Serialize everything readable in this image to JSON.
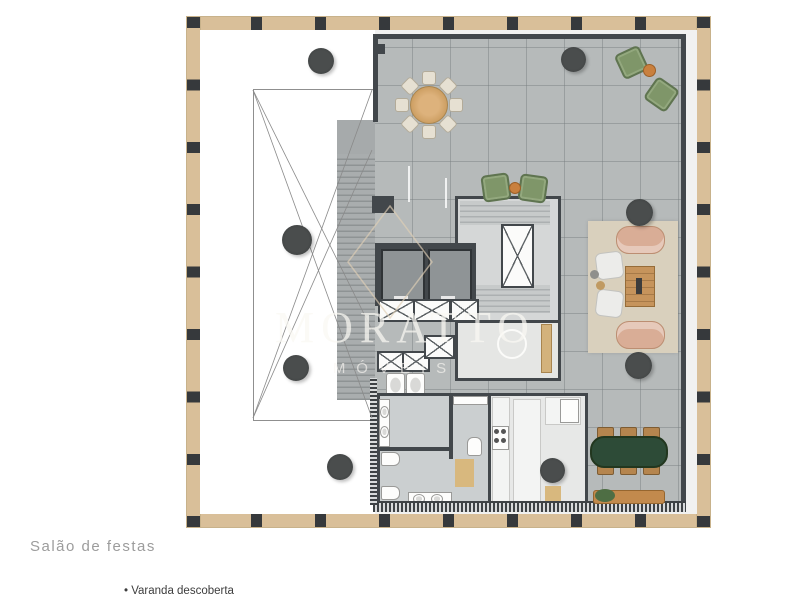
{
  "page": {
    "label_title": "Salão de festas",
    "label_bullet": "• Varanda descoberta"
  },
  "watermark": {
    "brand": "MORATTO",
    "sub": "MÓVEIS"
  },
  "palette": {
    "frame_wood": "#d9bf99",
    "frame_post": "#36393c",
    "deck_tile": "#b6baba",
    "wall_dark": "#42474b",
    "tree_marker": "#3d4040",
    "rug_beige": "#d9d0bd",
    "sofa_tan": "#d9ad96",
    "armchair_green": "#7f9669",
    "side_table_orange": "#c9803e",
    "round_table_wood": "#d2a671",
    "dining_table_green": "#2d4b37",
    "bench_wood": "#c28a4d",
    "doorway_wood": "#d8b87e"
  },
  "plan": {
    "type": "floor-plan",
    "features": [
      "uncovered-veranda-void",
      "pergola-frame",
      "tiled-deck",
      "main-staircase",
      "elevator-bank",
      "service-shafts",
      "secondary-staircase",
      "restrooms",
      "wc",
      "kitchen",
      "round-table-8-chairs",
      "green-armchair-pairs",
      "lounge-set",
      "oval-dining-table-6-chairs",
      "garden-bench",
      "planter-trees"
    ]
  }
}
